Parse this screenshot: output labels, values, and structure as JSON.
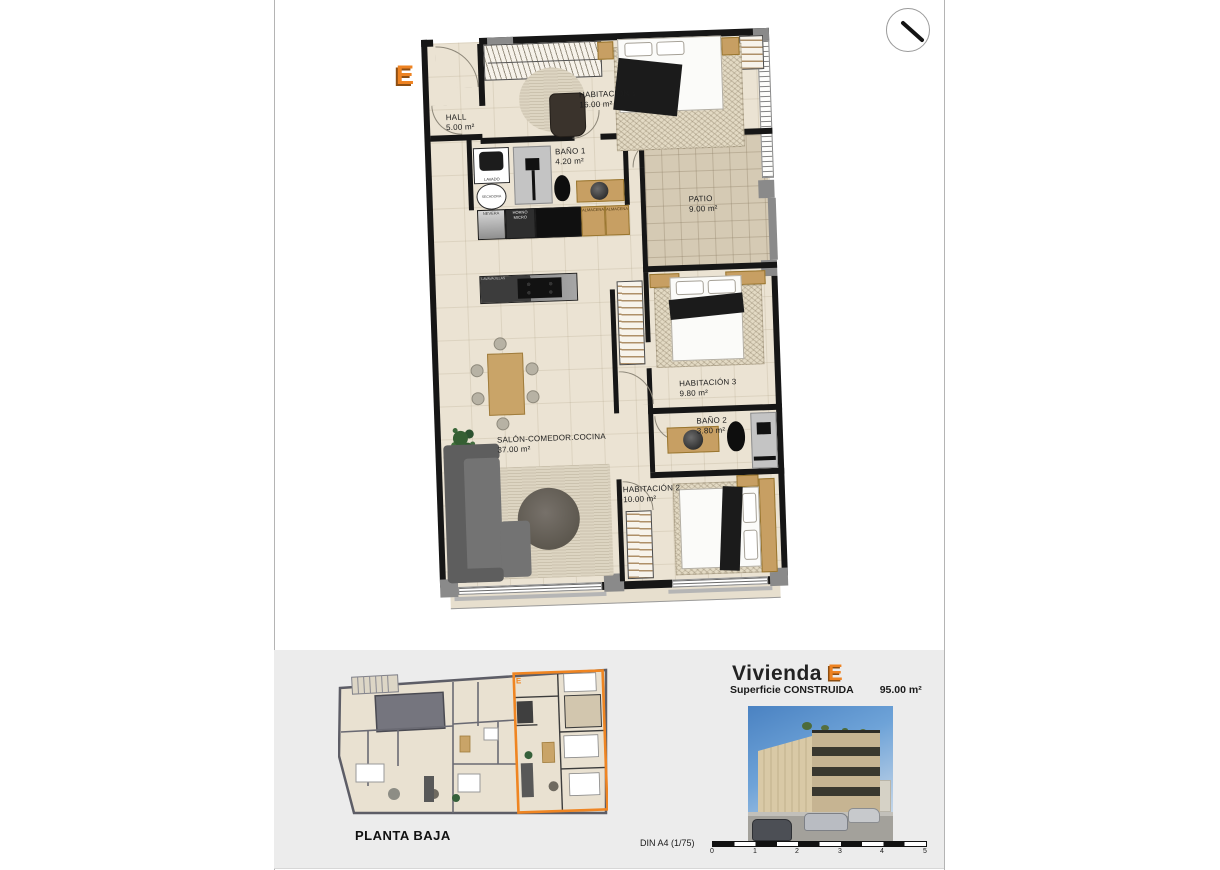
{
  "unit_letter": "E",
  "plan": {
    "rooms": [
      {
        "label": "HALL",
        "area": "5.00 m²"
      },
      {
        "label": "HABITACIÓN 1",
        "area": "16.00 m²"
      },
      {
        "label": "BAÑO 1",
        "area": "4.20 m²"
      },
      {
        "label": "PATIO",
        "area": "9.00 m²"
      },
      {
        "label": "SALÓN-COMEDOR.COCINA",
        "area": "37.00 m²"
      },
      {
        "label": "HABITACIÓN 3",
        "area": "9.80 m²"
      },
      {
        "label": "BAÑO 2",
        "area": "3.80 m²"
      },
      {
        "label": "HABITACIÓN 2",
        "area": "10.00 m²"
      }
    ],
    "appliances": {
      "lavado": "LAVADO",
      "secadora": "SECADORA",
      "nevera": "NEVERA",
      "horno_micro": "HORNO MICRO",
      "lavavajillas": "LAVAVAJILLAS",
      "almacenaje": "ALMACENAJE"
    }
  },
  "footer": {
    "mini_plan_label": "PLANTA BAJA",
    "dwelling_title": "Vivienda",
    "surface_label": "Superficie CONSTRUIDA",
    "surface_value": "95.00 m²",
    "scale_label": "DIN A4 (1/75)",
    "scale_ticks": [
      "0",
      "1",
      "2",
      "3",
      "4",
      "5"
    ]
  },
  "icons": {
    "compass": "north-arrow-icon"
  },
  "colors": {
    "accent_orange": "#ee8322",
    "wall": "#161616",
    "floor": "#ebe3d3",
    "patio_floor": "#d5cab4",
    "footer_panel": "#ececec"
  }
}
